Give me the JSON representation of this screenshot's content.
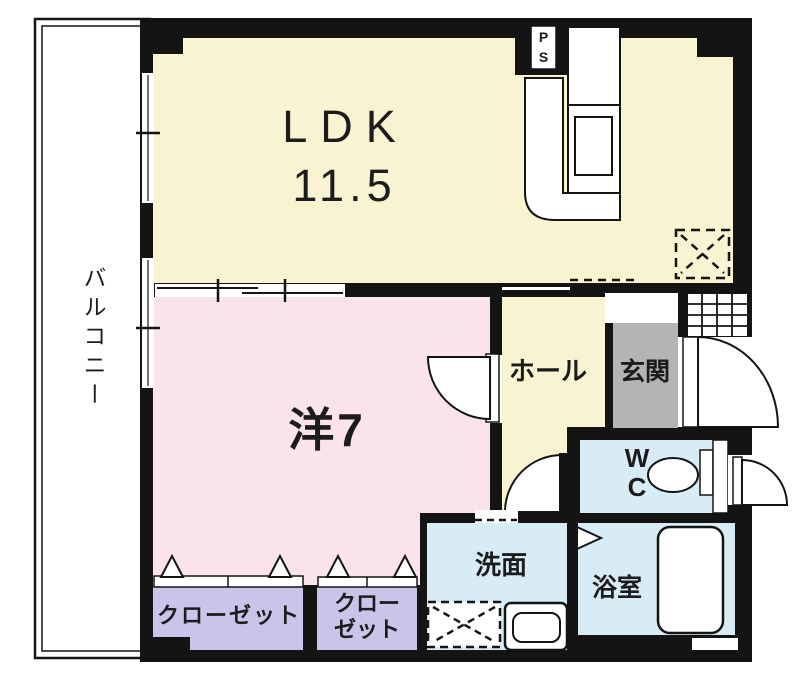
{
  "floorplan": {
    "colors": {
      "wall": "#141414",
      "ldk": "#f8f3d0",
      "bedroom": "#fbe3ee",
      "closet": "#c8c5e8",
      "wet_area": "#d8ecf5",
      "entrance_mat": "#b4b4b4",
      "line": "#141414",
      "text": "#1c1c1c"
    },
    "labels": {
      "balcony": "バルコニー",
      "ldk_name": "LDK",
      "ldk_size": "11.5",
      "western_room": "洋7",
      "hall": "ホール",
      "entrance": "玄関",
      "wc_line1": "W",
      "wc_line2": "C",
      "washroom": "洗面",
      "bathroom": "浴室",
      "closet_large": "クローゼット",
      "closet_small_line1": "クロー",
      "closet_small_line2": "ゼット",
      "pipe_space_line1": "P",
      "pipe_space_line2": "S"
    }
  }
}
